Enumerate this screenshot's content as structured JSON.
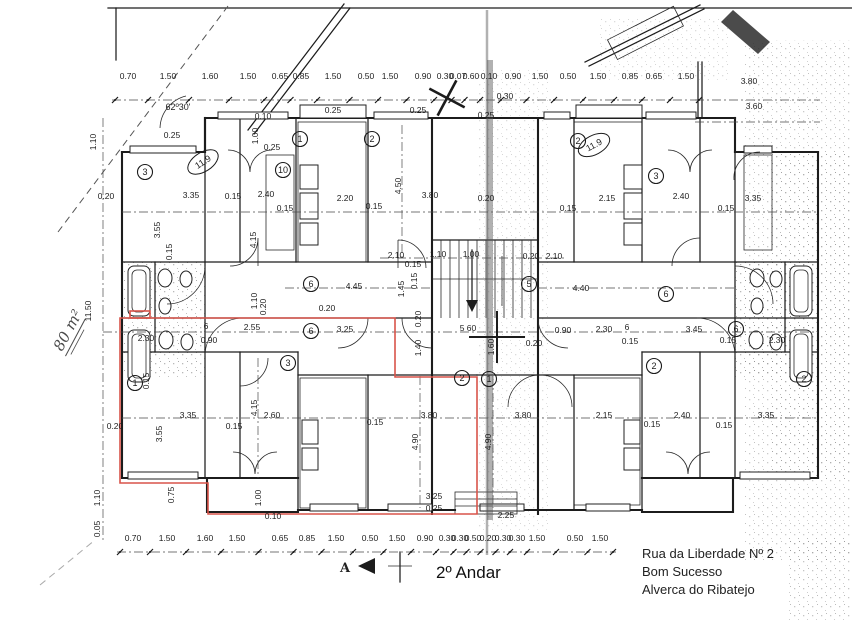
{
  "title": {
    "floor": "2º Andar"
  },
  "address": {
    "line1": "Rua da Liberdade Nº 2",
    "line2": "Bom Sucesso",
    "line3": "Alverca do Ribatejo"
  },
  "handwritten_area": "80 m²",
  "angle_label": "62º30'",
  "section_marker": "A",
  "colors": {
    "ink": "#1c1c1c",
    "highlight_red": "#d9544a",
    "paper": "#ffffff"
  },
  "dim_chains": {
    "top": {
      "line_y": 100,
      "label_y": 79,
      "labels": [
        {
          "t": "0.70",
          "x": 128
        },
        {
          "t": "1.50",
          "x": 168
        },
        {
          "t": "1.60",
          "x": 210
        },
        {
          "t": "1.50",
          "x": 248
        },
        {
          "t": "0.65",
          "x": 280
        },
        {
          "t": "0.85",
          "x": 301
        },
        {
          "t": "1.50",
          "x": 333
        },
        {
          "t": "0.50",
          "x": 366
        },
        {
          "t": "1.50",
          "x": 390
        },
        {
          "t": "0.90",
          "x": 423
        },
        {
          "t": "0.30",
          "x": 445
        },
        {
          "t": "0.07",
          "x": 458
        },
        {
          "t": "0.60",
          "x": 471
        },
        {
          "t": "0.10",
          "x": 489
        },
        {
          "t": "0.90",
          "x": 513
        },
        {
          "t": "1.50",
          "x": 540
        },
        {
          "t": "0.50",
          "x": 568
        },
        {
          "t": "1.50",
          "x": 598
        },
        {
          "t": "0.85",
          "x": 630
        },
        {
          "t": "0.65",
          "x": 654
        },
        {
          "t": "1.50",
          "x": 686
        }
      ]
    },
    "bottom": {
      "line_y": 552,
      "label_y": 541,
      "labels": [
        {
          "t": "0.70",
          "x": 133
        },
        {
          "t": "1.50",
          "x": 167
        },
        {
          "t": "1.60",
          "x": 205
        },
        {
          "t": "1.50",
          "x": 237
        },
        {
          "t": "0.65",
          "x": 280
        },
        {
          "t": "0.85",
          "x": 307
        },
        {
          "t": "1.50",
          "x": 336
        },
        {
          "t": "0.50",
          "x": 370
        },
        {
          "t": "1.50",
          "x": 397
        },
        {
          "t": "0.90",
          "x": 425
        },
        {
          "t": "0.30",
          "x": 447
        },
        {
          "t": "0.30",
          "x": 460
        },
        {
          "t": "0.50",
          "x": 473
        },
        {
          "t": "0.20",
          "x": 488
        },
        {
          "t": "0.30",
          "x": 503
        },
        {
          "t": "0.30",
          "x": 517
        },
        {
          "t": "1.50",
          "x": 537
        },
        {
          "t": "0.50",
          "x": 575
        },
        {
          "t": "1.50",
          "x": 600
        }
      ]
    }
  },
  "plan_labels": [
    {
      "t": "0.10",
      "x": 263,
      "y": 119
    },
    {
      "t": "0.25",
      "x": 172,
      "y": 138
    },
    {
      "t": "1.00",
      "x": 258,
      "y": 136,
      "r": -90
    },
    {
      "t": "0.25",
      "x": 272,
      "y": 150
    },
    {
      "t": "0.25",
      "x": 333,
      "y": 113
    },
    {
      "t": "0.25",
      "x": 418,
      "y": 113
    },
    {
      "t": "0.30",
      "x": 505,
      "y": 99
    },
    {
      "t": "0.25",
      "x": 486,
      "y": 118
    },
    {
      "t": "1.10",
      "x": 96,
      "y": 142,
      "r": -90
    },
    {
      "t": "0.20",
      "x": 106,
      "y": 199
    },
    {
      "t": "3.35",
      "x": 191,
      "y": 198
    },
    {
      "t": "0.15",
      "x": 233,
      "y": 199
    },
    {
      "t": "2.40",
      "x": 266,
      "y": 197
    },
    {
      "t": "0.15",
      "x": 285,
      "y": 211
    },
    {
      "t": "3.55",
      "x": 160,
      "y": 230,
      "r": -90
    },
    {
      "t": "4.15",
      "x": 256,
      "y": 240,
      "r": -90
    },
    {
      "t": "0.15",
      "x": 172,
      "y": 252,
      "r": -90
    },
    {
      "t": "2.20",
      "x": 345,
      "y": 201
    },
    {
      "t": "0.15",
      "x": 374,
      "y": 209
    },
    {
      "t": "4.50",
      "x": 401,
      "y": 186,
      "r": -90
    },
    {
      "t": "3.80",
      "x": 430,
      "y": 198
    },
    {
      "t": "0.20",
      "x": 486,
      "y": 201
    },
    {
      "t": "2.15",
      "x": 607,
      "y": 201
    },
    {
      "t": "0.15",
      "x": 568,
      "y": 211
    },
    {
      "t": "2.40",
      "x": 681,
      "y": 199
    },
    {
      "t": "0.15",
      "x": 726,
      "y": 211
    },
    {
      "t": "3.35",
      "x": 753,
      "y": 201
    },
    {
      "t": "3.80",
      "x": 749,
      "y": 84
    },
    {
      "t": "3.60",
      "x": 754,
      "y": 109
    },
    {
      "t": "2.10",
      "x": 396,
      "y": 258
    },
    {
      "t": "0.15",
      "x": 413,
      "y": 267
    },
    {
      "t": "1.10",
      "x": 438,
      "y": 257
    },
    {
      "t": "1.00",
      "x": 471,
      "y": 257
    },
    {
      "t": "0.20",
      "x": 531,
      "y": 259
    },
    {
      "t": "2.10",
      "x": 554,
      "y": 259
    },
    {
      "t": "4.45",
      "x": 354,
      "y": 289
    },
    {
      "t": "1.45",
      "x": 404,
      "y": 289,
      "r": -90
    },
    {
      "t": "0.15",
      "x": 417,
      "y": 281,
      "r": -90
    },
    {
      "t": "0.20",
      "x": 327,
      "y": 311
    },
    {
      "t": "3.25",
      "x": 345,
      "y": 332
    },
    {
      "t": "0.20",
      "x": 421,
      "y": 319,
      "r": -90
    },
    {
      "t": "1.40",
      "x": 421,
      "y": 348,
      "r": -90
    },
    {
      "t": "5 60",
      "x": 468,
      "y": 331
    },
    {
      "t": "1.60",
      "x": 494,
      "y": 347,
      "r": -90
    },
    {
      "t": "4.40",
      "x": 581,
      "y": 291
    },
    {
      "t": "0.90",
      "x": 563,
      "y": 333
    },
    {
      "t": "2.30",
      "x": 604,
      "y": 332
    },
    {
      "t": "6",
      "x": 627,
      "y": 330
    },
    {
      "t": "3.45",
      "x": 694,
      "y": 332
    },
    {
      "t": "0.15",
      "x": 630,
      "y": 344
    },
    {
      "t": "0.20",
      "x": 534,
      "y": 346
    },
    {
      "t": "0.15",
      "x": 728,
      "y": 343
    },
    {
      "t": "2.30",
      "x": 777,
      "y": 343
    },
    {
      "t": "6",
      "x": 206,
      "y": 329
    },
    {
      "t": "2.55",
      "x": 252,
      "y": 330
    },
    {
      "t": "0.90",
      "x": 209,
      "y": 343
    },
    {
      "t": "2.30",
      "x": 146,
      "y": 341
    },
    {
      "t": "1.10",
      "x": 257,
      "y": 301,
      "r": -90
    },
    {
      "t": "0.20",
      "x": 266,
      "y": 307,
      "r": -90
    },
    {
      "t": "11.50",
      "x": 91,
      "y": 311,
      "r": -90
    },
    {
      "t": "0.15",
      "x": 149,
      "y": 381,
      "r": -90
    },
    {
      "t": "0.20",
      "x": 115,
      "y": 429
    },
    {
      "t": "3.35",
      "x": 188,
      "y": 418
    },
    {
      "t": "3.55",
      "x": 162,
      "y": 434,
      "r": -90
    },
    {
      "t": "0.15",
      "x": 234,
      "y": 429
    },
    {
      "t": "2.60",
      "x": 272,
      "y": 418
    },
    {
      "t": "4.15",
      "x": 257,
      "y": 408,
      "r": -90
    },
    {
      "t": "0.15",
      "x": 375,
      "y": 425
    },
    {
      "t": "3.80",
      "x": 429,
      "y": 418
    },
    {
      "t": "4.90",
      "x": 418,
      "y": 442,
      "r": -90
    },
    {
      "t": "4.90",
      "x": 491,
      "y": 442,
      "r": -90
    },
    {
      "t": "3.80",
      "x": 523,
      "y": 418
    },
    {
      "t": "2.15",
      "x": 604,
      "y": 418
    },
    {
      "t": "0.15",
      "x": 652,
      "y": 427
    },
    {
      "t": "2.40",
      "x": 682,
      "y": 418
    },
    {
      "t": "0.15",
      "x": 724,
      "y": 428
    },
    {
      "t": "3.35",
      "x": 766,
      "y": 418
    },
    {
      "t": "0.75",
      "x": 174,
      "y": 495,
      "r": -90
    },
    {
      "t": "1.00",
      "x": 261,
      "y": 498,
      "r": -90
    },
    {
      "t": "0.10",
      "x": 273,
      "y": 519
    },
    {
      "t": "3.25",
      "x": 434,
      "y": 499
    },
    {
      "t": "0.25",
      "x": 434,
      "y": 511
    },
    {
      "t": "2.25",
      "x": 506,
      "y": 518
    },
    {
      "t": "1.10",
      "x": 100,
      "y": 498,
      "r": -90
    },
    {
      "t": "0.05",
      "x": 100,
      "y": 529,
      "r": -90
    }
  ],
  "room_badges": [
    {
      "n": "3",
      "x": 145,
      "y": 172
    },
    {
      "n": "10",
      "x": 283,
      "y": 170
    },
    {
      "n": "1",
      "x": 300,
      "y": 139
    },
    {
      "n": "2",
      "x": 372,
      "y": 139
    },
    {
      "n": "2",
      "x": 578,
      "y": 141
    },
    {
      "n": "3",
      "x": 656,
      "y": 176
    },
    {
      "n": "6",
      "x": 311,
      "y": 284
    },
    {
      "n": "5",
      "x": 529,
      "y": 284
    },
    {
      "n": "6",
      "x": 666,
      "y": 294
    },
    {
      "n": "6",
      "x": 311,
      "y": 331
    },
    {
      "n": "6",
      "x": 736,
      "y": 329
    },
    {
      "n": "1",
      "x": 135,
      "y": 383
    },
    {
      "n": "3",
      "x": 288,
      "y": 363
    },
    {
      "n": "2",
      "x": 462,
      "y": 378
    },
    {
      "n": "1",
      "x": 489,
      "y": 379
    },
    {
      "n": "2",
      "x": 654,
      "y": 366
    },
    {
      "n": "2",
      "x": 804,
      "y": 379
    }
  ],
  "area_ellipses": [
    {
      "t": "11.9",
      "x": 203,
      "y": 162,
      "r": -33
    },
    {
      "t": "11.9",
      "x": 594,
      "y": 145,
      "r": -28
    }
  ]
}
